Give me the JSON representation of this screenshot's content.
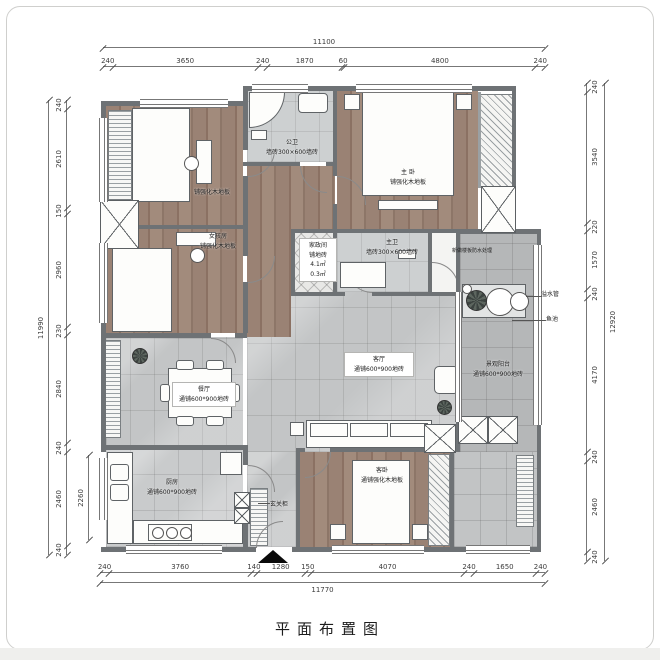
{
  "title": "平面布置图",
  "colors": {
    "wall": "#6e7275",
    "wood_floor": "#967e6f",
    "tile_floor": "#c3c5c6",
    "balcony_floor": "#b5b7b8"
  },
  "dimensions": {
    "top": {
      "overall": "11100",
      "segments": [
        "240",
        "3650",
        "240",
        "1870",
        "60",
        "4800",
        "240"
      ]
    },
    "bottom": {
      "overall": "11770",
      "segments": [
        "240",
        "3760",
        "140",
        "1280",
        "150",
        "4070",
        "240",
        "1650",
        "240"
      ]
    },
    "left": {
      "overall": "11990",
      "inner": "2260",
      "segments": [
        "240",
        "2610",
        "150",
        "2960",
        "230",
        "2840",
        "240",
        "2460",
        "240"
      ]
    },
    "right": {
      "overall": "12920",
      "segments": [
        "240",
        "3540",
        "220",
        "1570",
        "240",
        "4170",
        "240",
        "2460",
        "240"
      ]
    }
  },
  "rooms": {
    "bedroom_top": {
      "floor": "铺强化木地板"
    },
    "bedroom_girl": {
      "name": "女孩房",
      "floor": "铺强化木地板"
    },
    "public_bath": {
      "name": "公卫",
      "floor": "墙砖300×600墙砖"
    },
    "master_bedroom": {
      "name": "主 卧",
      "floor": "铺强化木地板"
    },
    "master_bath": {
      "name": "主卫",
      "floor": "墙砖300×600墙砖"
    },
    "utility": {
      "name": "家政间",
      "l2": "铺地砖",
      "l3": "4.1㎡",
      "l4": "0.3㎡"
    },
    "living": {
      "name": "客厅",
      "floor": "通铺600*900地砖"
    },
    "dining": {
      "name": "餐厅",
      "floor": "通铺600*900地砖"
    },
    "kitchen": {
      "name": "厨房",
      "floor": "通铺600*900地砖"
    },
    "guest_bedroom": {
      "name": "客卧",
      "floor": "通铺强化木地板"
    },
    "balcony": {
      "name": "景观阳台",
      "floor": "通铺600*900地砖"
    }
  },
  "annotations": {
    "overflow_pipe": "溢水管",
    "fish_pond": "鱼池",
    "entry_cabinet": "玄关柜",
    "waterproof_note": "新做楼板防水处理"
  }
}
